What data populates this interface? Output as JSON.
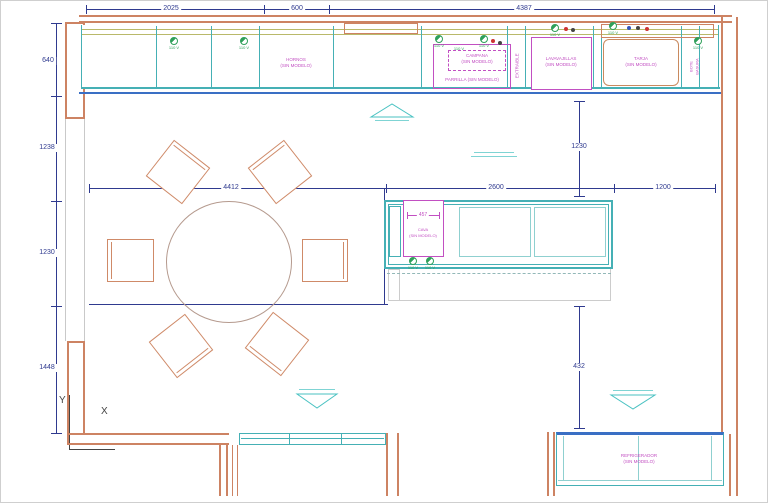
{
  "drawing": {
    "type": "kitchen-floor-plan-cad",
    "axis": {
      "x_label": "X",
      "y_label": "Y"
    },
    "outlet_label": "110 V",
    "dims": {
      "top": [
        "2025",
        "600",
        "4387"
      ],
      "left": [
        "640",
        "1238",
        "1230",
        "1448"
      ],
      "mid": [
        "4412",
        "2600",
        "1200"
      ],
      "right_upper": "1230",
      "right_lower": "432",
      "island_width": "457"
    },
    "labels": {
      "hornos_1": "HORNOS",
      "hornos_2": "(SIN MODELO)",
      "campana_1": "CAMPANA",
      "campana_2": "(SIN MODELO)",
      "parrilla": "PARRILLA (SIN MODELO)",
      "extraible": "EXTRAIBLE",
      "lavavajillas_1": "LAVAVAJILLAS",
      "lavavajillas_2": "(SIN MODELO)",
      "tarja_1": "TARJA",
      "tarja_2": "(SIN MODELO)",
      "bote_1": "BOTE",
      "bote_2": "BASURA",
      "cava_1": "CAVA",
      "cava_2": "(SIN MODELO)",
      "refrigerador_1": "REFRIGERADOR",
      "refrigerador_2": "(SIN MODELO)"
    },
    "colors": {
      "wall": "#cd8363",
      "cabinet": "#45b0b5",
      "dimension": "#2f3a8f",
      "appliance_text": "#c24fc2",
      "outlet": "#2fa05a",
      "accent_blue": "#3a6fc4",
      "counter_edge": "#b9b96a",
      "marker": "#4ac2c2"
    }
  }
}
